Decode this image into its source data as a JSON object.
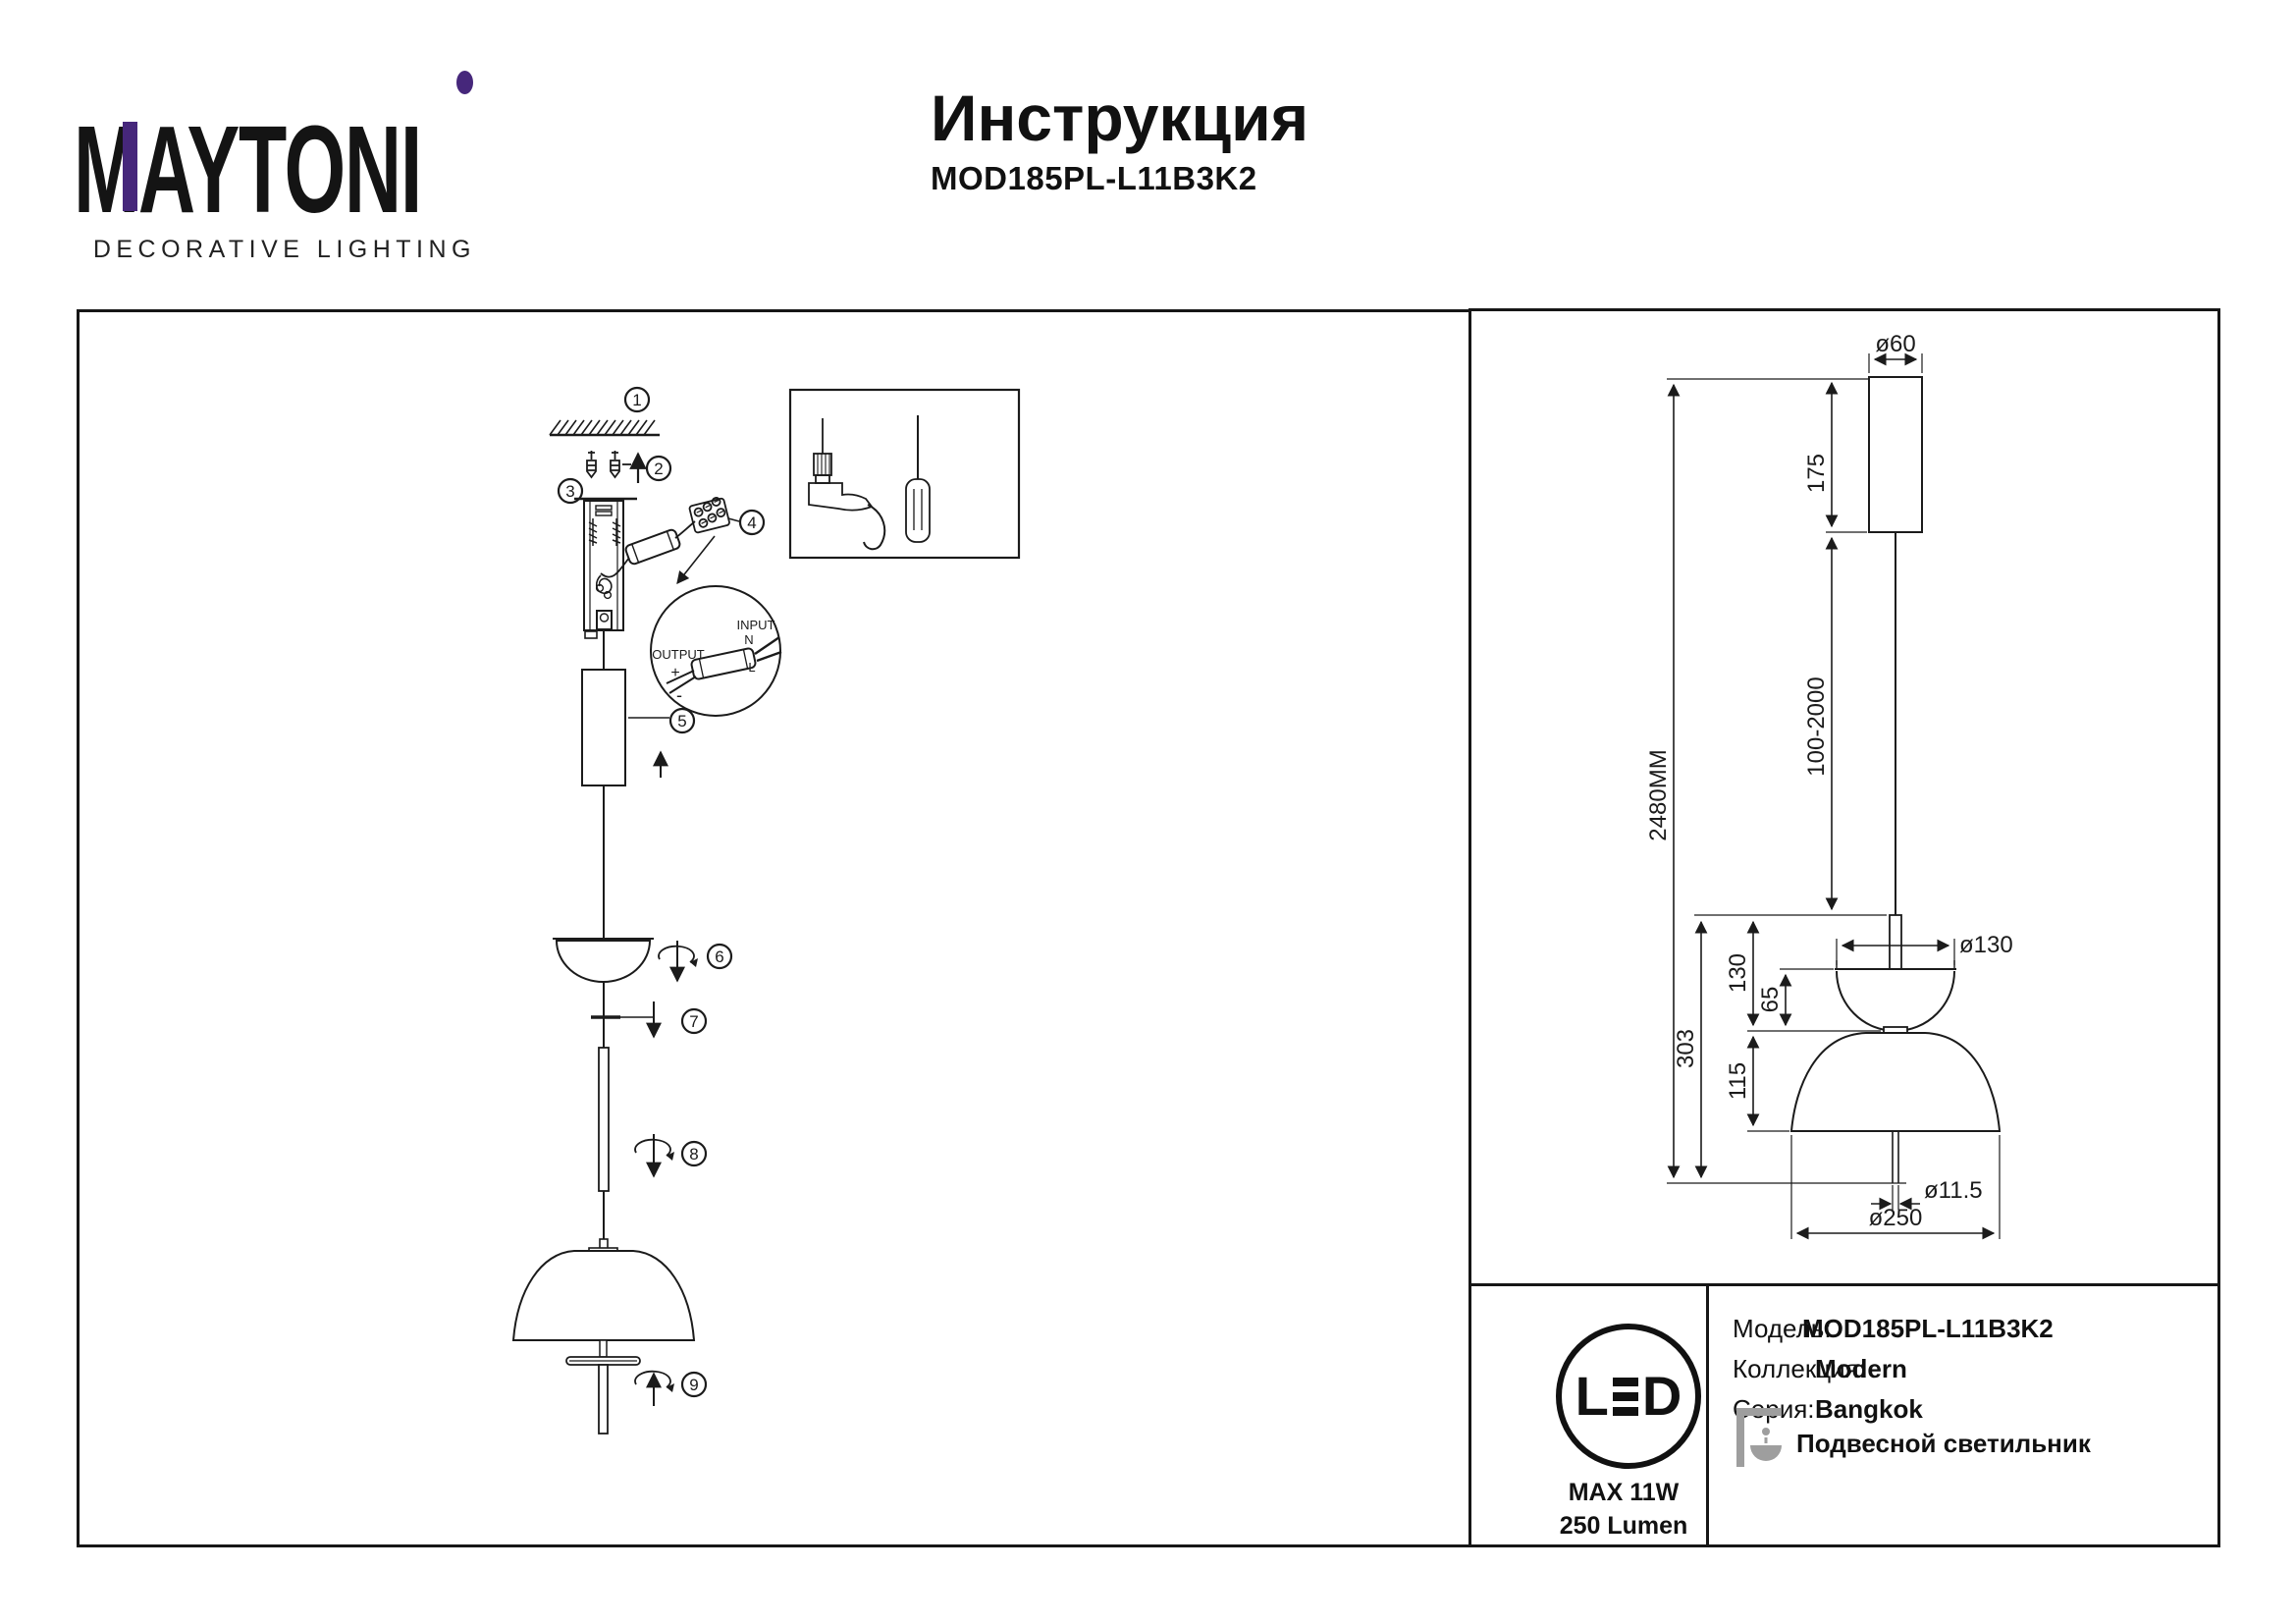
{
  "brand": {
    "logo": "MAYTONI",
    "tagline": "DECORATIVE LIGHTING"
  },
  "header": {
    "title": "Инструкция",
    "model": "MOD185PL-L11B3K2"
  },
  "steps": [
    "1",
    "2",
    "3",
    "4",
    "5",
    "6",
    "7",
    "8",
    "9"
  ],
  "detail": {
    "output": "OUTPUT",
    "plus": "+",
    "minus": "-",
    "input": "INPUT",
    "n": "N",
    "l": "L"
  },
  "dimensions": {
    "d60": "ø60",
    "h175": "175",
    "wire": "100-2000",
    "total": "2480MM",
    "h303": "303",
    "h130": "130",
    "h65": "65",
    "h115": "115",
    "d130": "ø130",
    "d115": "ø11.5",
    "d250": "ø250"
  },
  "spec": {
    "led_l": "L",
    "led_d": "D",
    "max_power": "MAX 11W",
    "lumen": "250 Lumen"
  },
  "info": {
    "rows": [
      {
        "label": "Модель:",
        "value": "MOD185PL-L11B3K2"
      },
      {
        "label": "Коллекция:",
        "value": "Modern"
      },
      {
        "label": "Серия:",
        "value": "Bangkok"
      }
    ],
    "type": "Подвесной светильник"
  },
  "colors": {
    "brand_purple": "#46277b",
    "ink": "#1b1b1b",
    "icon_gray": "#9e9e9e"
  }
}
